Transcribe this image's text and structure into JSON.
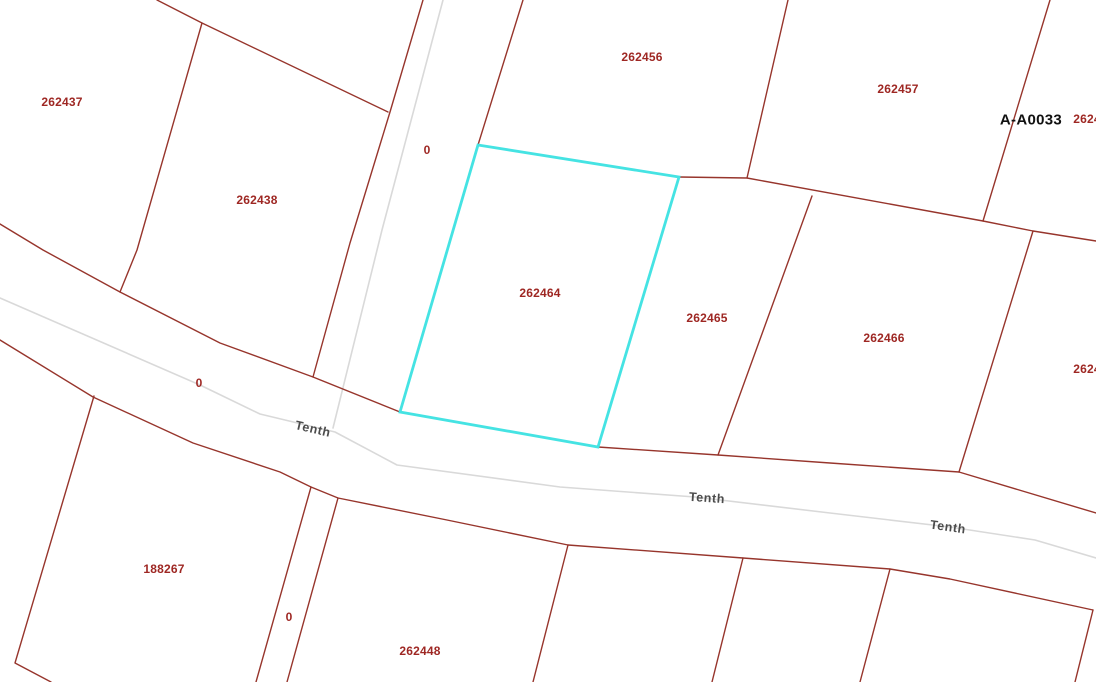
{
  "map": {
    "colors": {
      "background": "#ffffff",
      "parcel_line": "#97352c",
      "parcel_label": "#9e2723",
      "road_line": "#d9d9d9",
      "street_label": "#4c4c4c",
      "highlight": "#45e3e3",
      "survey_label": "#111111"
    },
    "parcel_labels": [
      {
        "text": "262437",
        "x": 62,
        "y": 102
      },
      {
        "text": "262438",
        "x": 257,
        "y": 200
      },
      {
        "text": "262456",
        "x": 642,
        "y": 57
      },
      {
        "text": "262457",
        "x": 898,
        "y": 89
      },
      {
        "text": "262464",
        "x": 540,
        "y": 293
      },
      {
        "text": "262465",
        "x": 707,
        "y": 318
      },
      {
        "text": "262466",
        "x": 884,
        "y": 338
      },
      {
        "text": "188267",
        "x": 164,
        "y": 569
      },
      {
        "text": "262448",
        "x": 420,
        "y": 651
      },
      {
        "text": "2624",
        "x": 1087,
        "y": 119
      },
      {
        "text": "2624",
        "x": 1087,
        "y": 369
      }
    ],
    "zero_labels": [
      {
        "text": "0",
        "x": 427,
        "y": 150
      },
      {
        "text": "0",
        "x": 199,
        "y": 383
      },
      {
        "text": "0",
        "x": 289,
        "y": 617
      }
    ],
    "street_labels": [
      {
        "text": "Tenth",
        "x": 313,
        "y": 429,
        "rot": 13
      },
      {
        "text": "Tenth",
        "x": 707,
        "y": 498,
        "rot": 4
      },
      {
        "text": "Tenth",
        "x": 948,
        "y": 527,
        "rot": 8
      }
    ],
    "survey_label": {
      "text": "A-A0033",
      "x": 1031,
      "y": 120
    },
    "highlighted_parcel": {
      "id": "262464",
      "points": "478,145 679,177 598,447 400,412"
    },
    "road_lines": [
      "443,0 382,230 333,428",
      "0,298 200,385 260,414 335,432 397,465 560,487 695,497 830,513 950,527 1035,540 1096,558"
    ],
    "parcel_lines": [
      "157,0 202,23 388,112",
      "202,23 137,250 120,292",
      "423,0 390,112 350,243 313,377",
      "523,0 478,145",
      "788,0 747,178",
      "1050,0 983,221",
      "679,177 747,178 983,221 1033,231 1096,241",
      "1033,231 959,472",
      "812,196 718,455",
      "0,224 43,250 120,292 220,343 313,377 400,412",
      "598,447 718,455 830,463 959,472 1096,513",
      "0,340 93,397 193,443 280,472 311,487 338,498 447,520 568,545 743,558 890,569 950,579 1093,610",
      "1093,610 1075,682",
      "94,396 15,663 51,682",
      "311,487 256,682",
      "338,498 287,682",
      "568,545 533,682",
      "743,558 712,682",
      "890,569 860,682"
    ]
  }
}
